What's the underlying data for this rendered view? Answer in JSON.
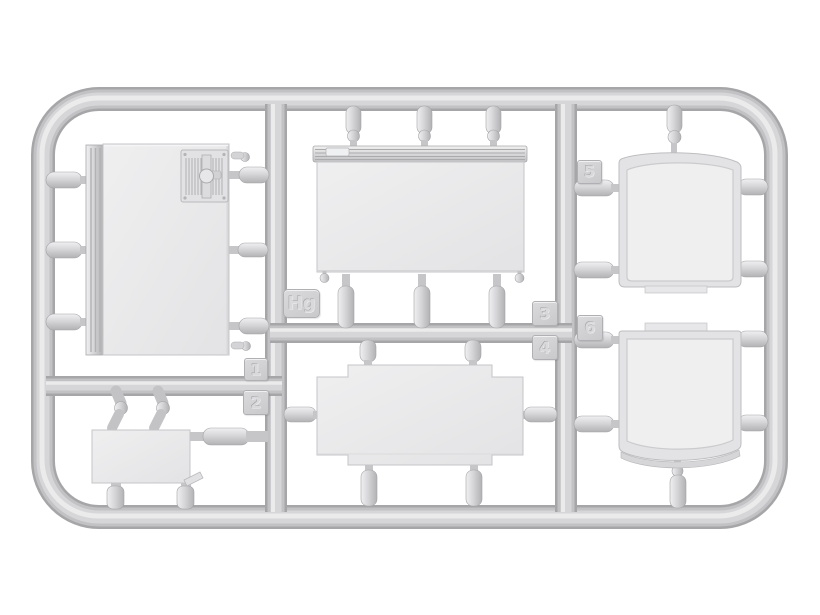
{
  "scene": {
    "description": "Light-gray injection-molded model kit sprue (runner frame) holding six flat panel parts",
    "background_color": "#ffffff",
    "plastic_color": "#c9c9cc",
    "panel_color": "#ebebed",
    "highlight_color": "#ededef",
    "shadow_color": "#a6a6a9"
  },
  "sprue": {
    "id_tag": {
      "label": "Hg"
    },
    "part_tags": [
      {
        "label": "1"
      },
      {
        "label": "2"
      },
      {
        "label": "3"
      },
      {
        "label": "4"
      },
      {
        "label": "5"
      },
      {
        "label": "6"
      }
    ],
    "parts": [
      {
        "number": "1",
        "name": "door-panel-with-vent-grille"
      },
      {
        "number": "2",
        "name": "small-hatch-panel"
      },
      {
        "number": "3",
        "name": "box-side-panel-with-ribbed-rail"
      },
      {
        "number": "4",
        "name": "cross-shaped-floor-panel"
      },
      {
        "number": "5",
        "name": "curved-side-panel-upper"
      },
      {
        "number": "6",
        "name": "curved-side-panel-lower"
      }
    ]
  }
}
